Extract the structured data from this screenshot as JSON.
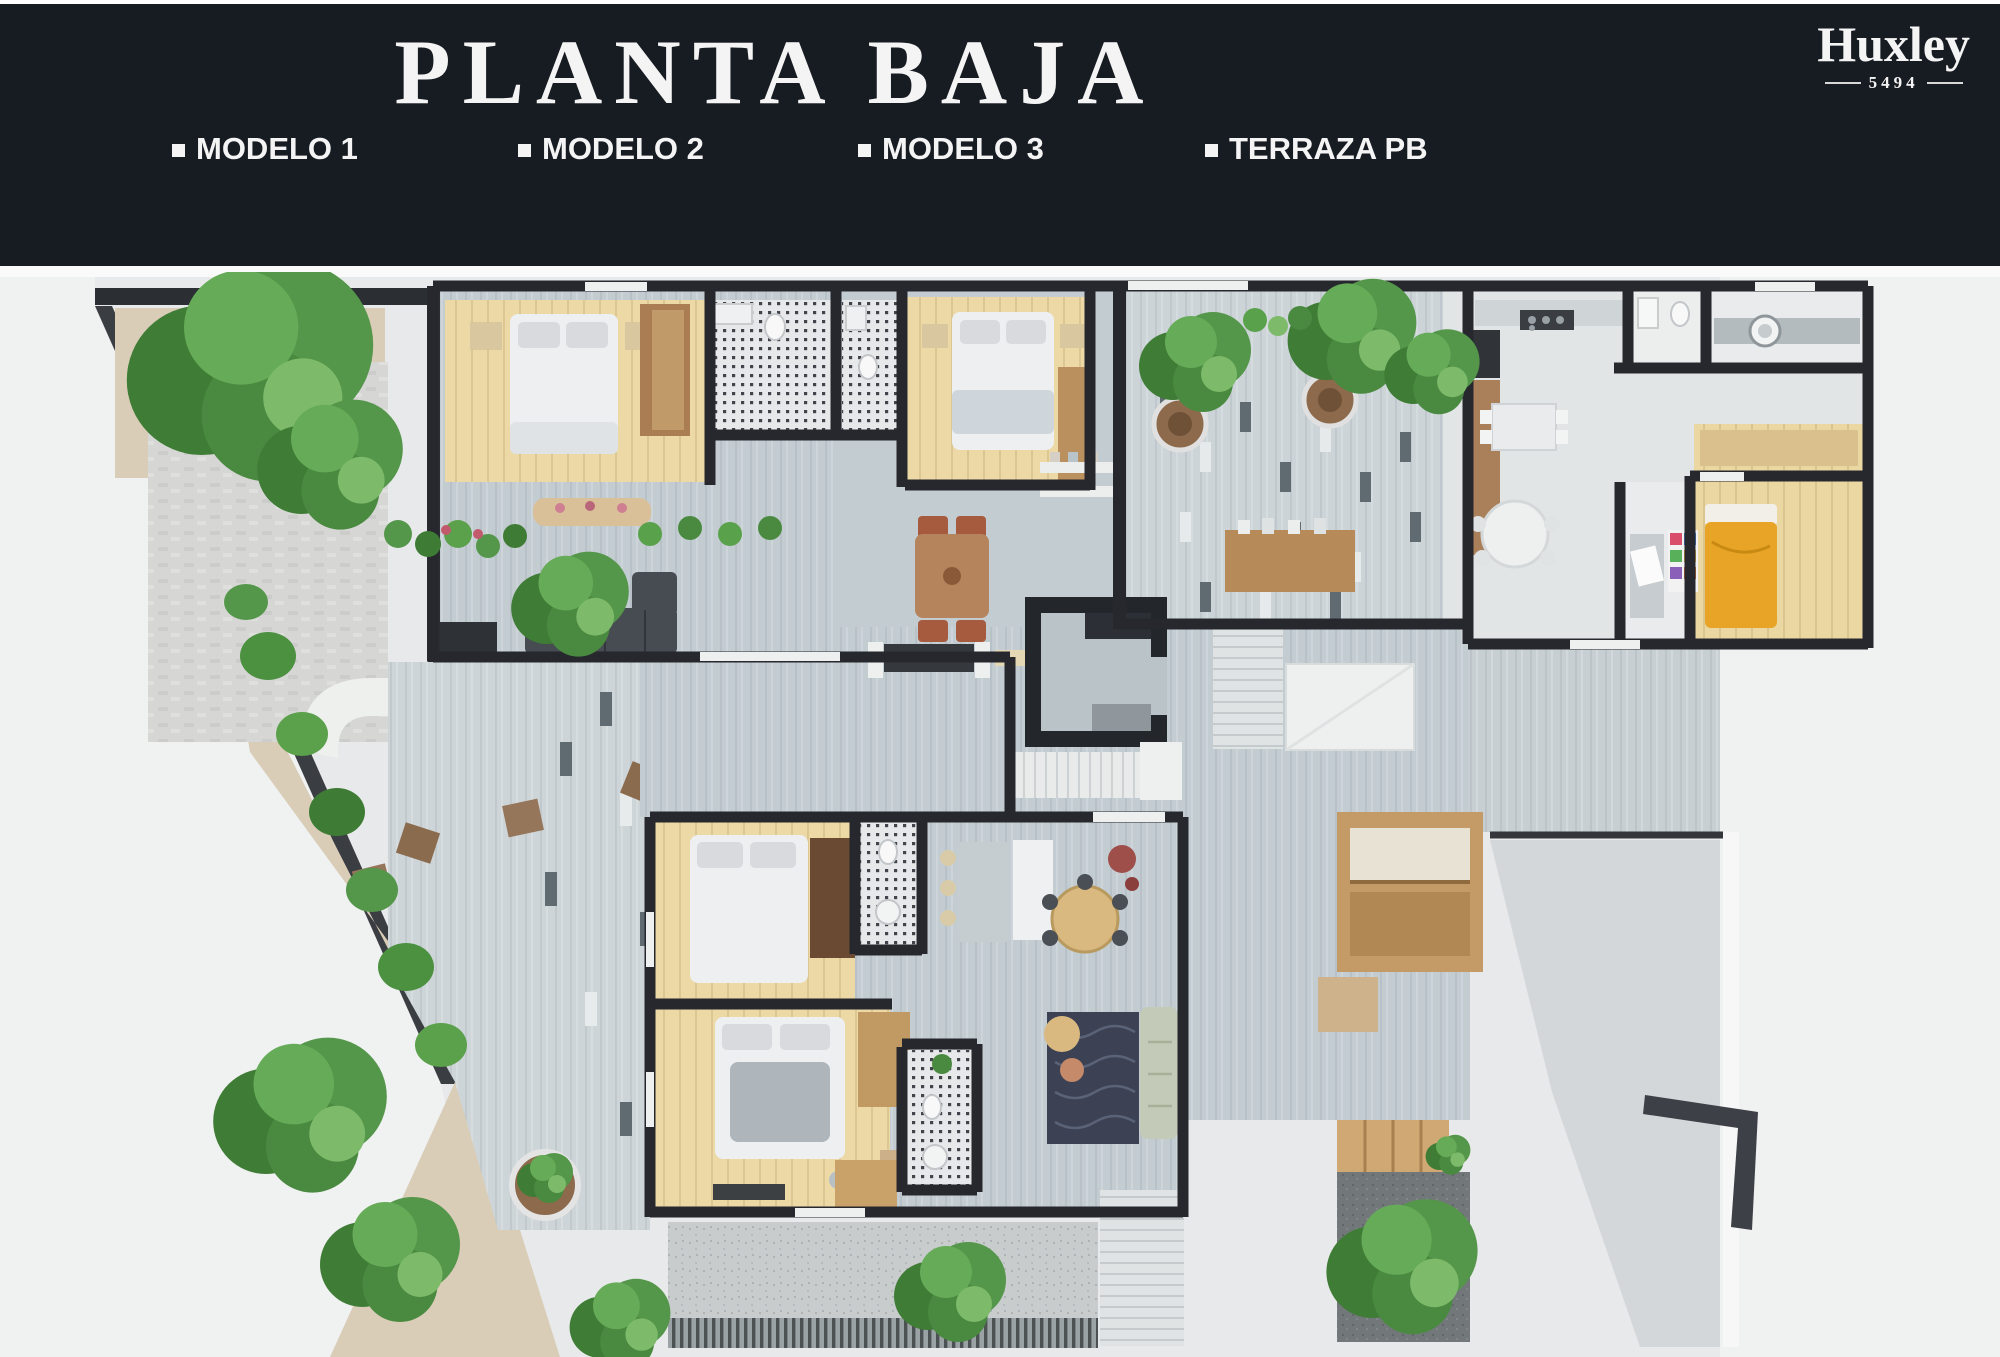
{
  "header": {
    "title": "PLANTA BAJA",
    "legend": [
      {
        "label": "MODELO 1"
      },
      {
        "label": "MODELO 2"
      },
      {
        "label": "MODELO 3"
      },
      {
        "label": "TERRAZA PB"
      }
    ],
    "brand": {
      "name": "Huxley",
      "number": "5494"
    }
  },
  "theme": {
    "header-bg": "#171b22",
    "header-text": "#f4f4f4",
    "plan-bg": "#e8e9ea",
    "wall": "#26282d",
    "wood-floor": "#ecd9a5",
    "tile-floor": "#c3ccd1",
    "accent-green": "#54964a",
    "accent-orange": "#e8a426"
  }
}
